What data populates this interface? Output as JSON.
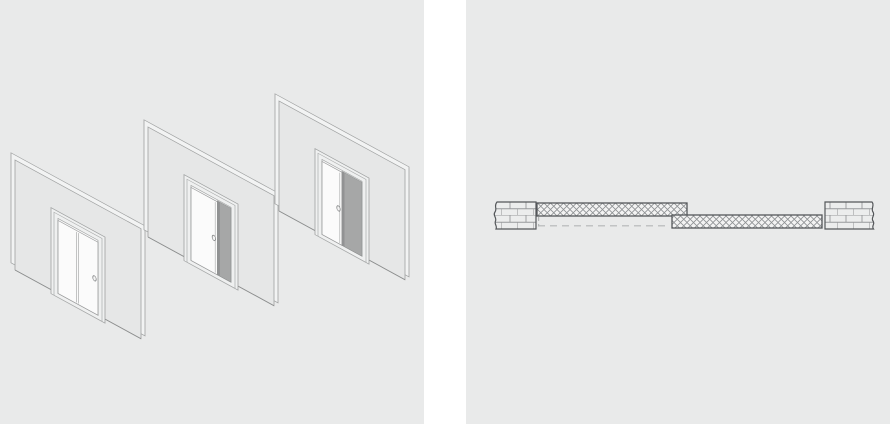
{
  "page": {
    "background_color": "#ffffff",
    "panel_background_color": "#e9eaea",
    "gutter_width_px": 42
  },
  "left_panel": {
    "title": "pocket-sliding-door-isometric-sequence",
    "colors": {
      "wall_face": "#e6e7e7",
      "wall_edge_face": "#f2f3f3",
      "frame": "#eff0f0",
      "door": "#fbfbfb",
      "opening_gap": "#a6a7a7",
      "opening_gap_shade": "#919293",
      "outline": "#9fa1a1",
      "dark_outline": "#8d8f8f"
    },
    "walls": [
      {
        "id": "wall-door-closed",
        "door_state": "closed",
        "open_fraction": 0.0
      },
      {
        "id": "wall-door-half-open",
        "door_state": "half-open",
        "open_fraction": 0.34
      },
      {
        "id": "wall-door-open",
        "door_state": "open",
        "open_fraction": 0.5
      }
    ],
    "wall_geometry": {
      "origins": [
        [
          15,
          160
        ],
        [
          148,
          127
        ],
        [
          279,
          101
        ]
      ],
      "skew_deg": 28.6,
      "face_w": 126,
      "face_h": 110,
      "opening_x": 43,
      "opening_w": 40,
      "door_top": 37,
      "door_h": 73
    }
  },
  "right_panel": {
    "title": "pocket-sliding-door-plan-section",
    "colors": {
      "masonry_fill": "#eceded",
      "mortar_line": "#97999b",
      "cassette_fill": "#f3f3f3",
      "hatch_line": "#8d9092",
      "outline": "#54575a",
      "dashed_line": "#b4b6b7"
    },
    "segments": [
      {
        "type": "masonry-wall",
        "side": "left",
        "pattern": "brick"
      },
      {
        "type": "pocket-cassette",
        "pattern": "diamond-hatch"
      },
      {
        "type": "retracted-door-dashed-outline"
      },
      {
        "type": "door-panel",
        "pattern": "diamond-hatch"
      },
      {
        "type": "masonry-wall",
        "side": "right",
        "pattern": "brick"
      }
    ]
  }
}
